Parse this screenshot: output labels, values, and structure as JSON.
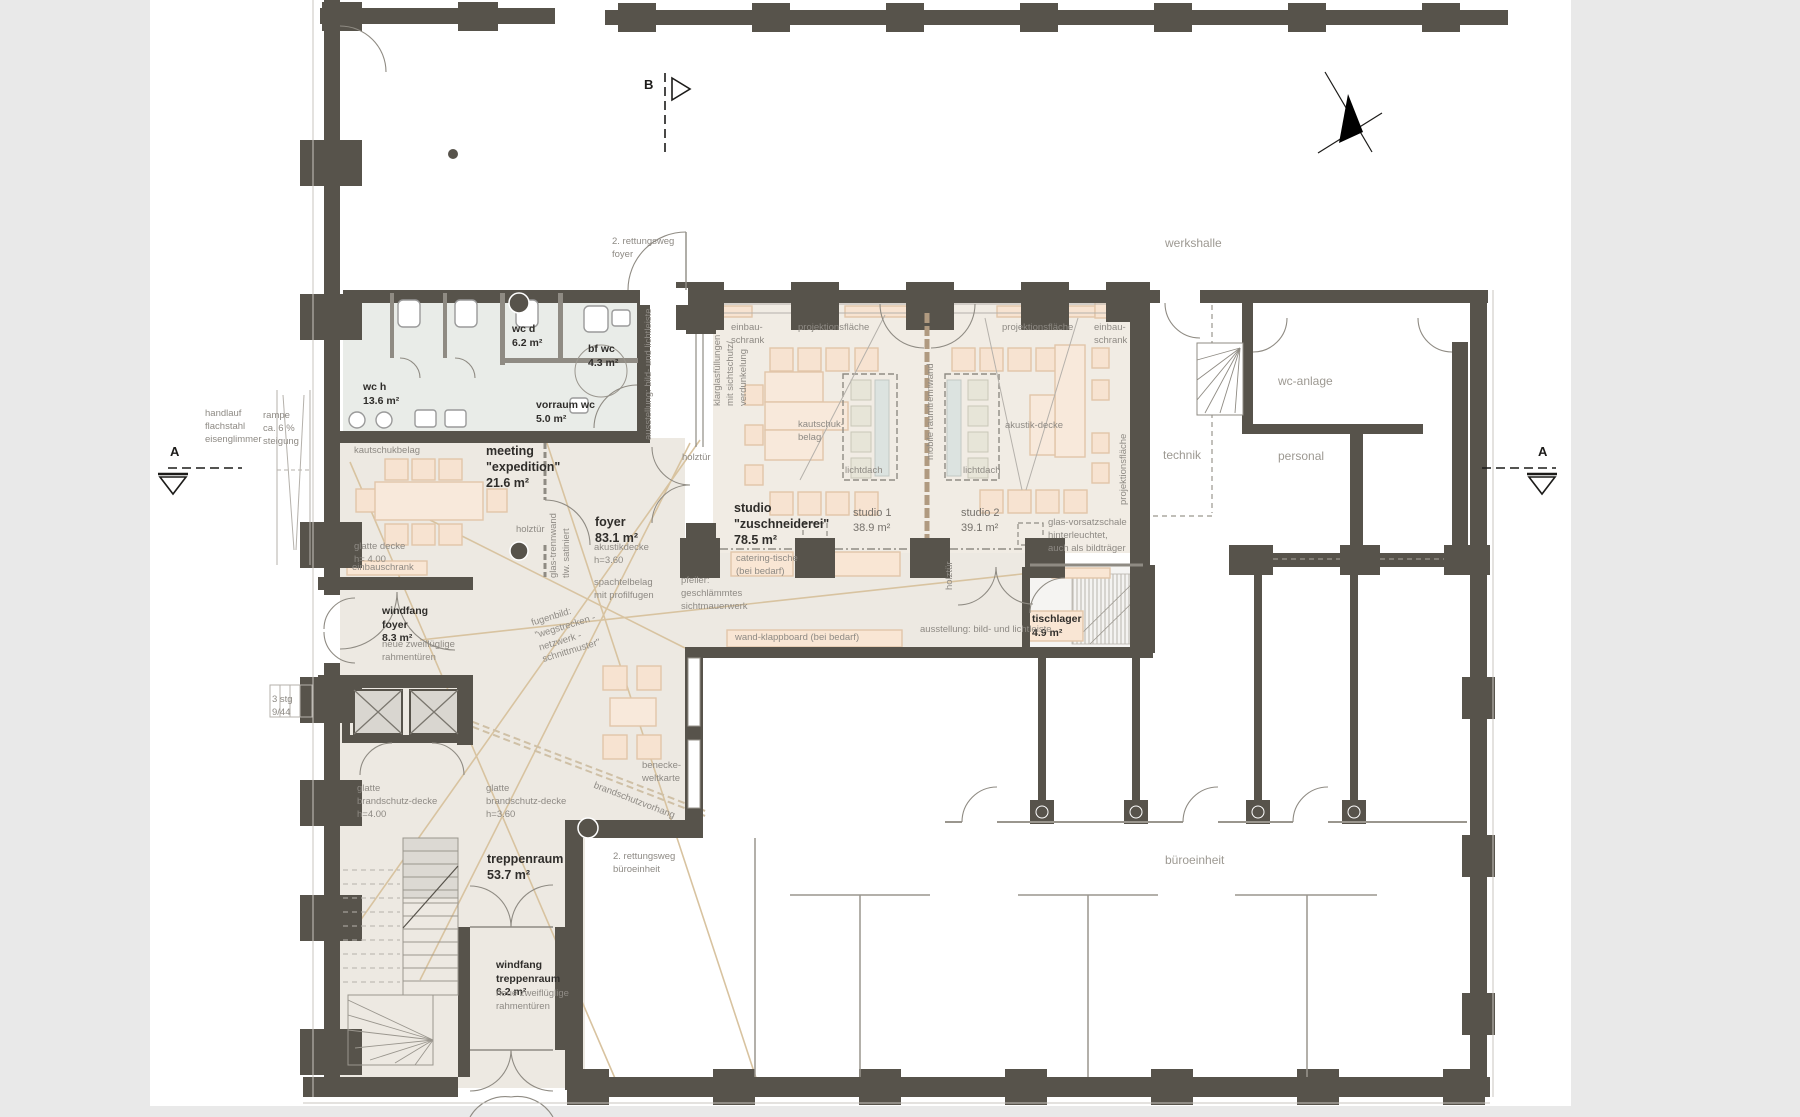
{
  "markers": {
    "a_left": "A",
    "a_right": "A",
    "b_top": "B"
  },
  "context": {
    "werkshalle": "werkshalle",
    "bueroeinheit": "büroeinheit",
    "technik": "technik",
    "wc_anlage": "wc-anlage",
    "personal": "personal"
  },
  "rooms": {
    "wc_h": "wc h\n13.6 m²",
    "wc_d": "wc d\n6.2 m²",
    "bf_wc": "bf wc\n4.3 m²",
    "vorraum_wc": "vorraum wc\n5.0 m²",
    "meeting": "meeting\n\"expedition\"\n21.6 m²",
    "foyer": "foyer\n83.1 m²",
    "studio_zuschneiderei": "studio\n\"zuschneiderei\"\n78.5 m²",
    "studio_1": "studio 1\n38.9 m²",
    "studio_2": "studio 2\n39.1 m²",
    "windfang_foyer": "windfang\nfoyer\n8.3 m²",
    "treppenraum": "treppenraum\n53.7 m²",
    "windfang_treppenraum": "windfang\ntreppenraum\n6.2 m²",
    "tischlager": "tischlager\n4.9 m²"
  },
  "annotations": {
    "handlauf": "handlauf\nflachstahl\neisenglimmer",
    "rampe": "rampe\nca. 6 %\nsteigung",
    "rettungsweg_foyer": "2. rettungsweg\nfoyer",
    "rettungsweg_buero": "2. rettungsweg\nbüroeinheit",
    "kautschukbelag_meeting": "kautschukbelag",
    "glatte_decke_meeting": "glatte decke\nh= 4.00",
    "einbauschrank_meeting": "einbauschrank",
    "glas_trennwand": "glas-trennwand\ntlw. satiniert",
    "holztuer_meeting": "holztür",
    "holztuer_foyer": "holztür",
    "holztuer_studio2": "holztür",
    "ausstellung_vertikal": "ausstellung: bild- und lichtleiste",
    "ausstellung_horizontal": "ausstellung: bild- und lichtleiste",
    "einbau_schrank_1": "einbau-\nschrank",
    "einbau_schrank_2": "einbau-\nschrank",
    "projektionsflaeche_1": "projektionsfläche",
    "projektionsflaeche_2": "projektionsfläche",
    "projektionsflaeche_v": "projektionsfläche",
    "klarglas": "klarglasfüllungen\nmit sichtschutz/\nverdunkelung",
    "kautschuk_belag_studio": "kautschuk-\nbelag",
    "lichtdach_1": "lichtdach",
    "lichtdach_2": "lichtdach",
    "akustik_decke": "akustik-decke",
    "mobile_raumtrennwand": "mobile raumtrennwand",
    "glas_vorsatzschale": "glas-vorsatzschale\nhinterleuchtet,\nauch als bildträger",
    "catering_tische": "catering-tische\n(bei bedarf)",
    "wand_klappboard": "wand-klappboard (bei bedarf)",
    "pfeiler": "pfeiler:\ngeschlämmtes\nsichtmauerwerk",
    "akustikdecke_foyer": "akustikdecke\nh=3.60",
    "spachtelbelag": "spachtelbelag\nmit profilfugen",
    "fugenbild": "fugenbild:\n\"wegstrecken -\nnetzwerk -\nschnittmuster\"",
    "benecke": "benecke-\nweltkarte",
    "brandschutzvorhang": "brandschutzvorhang",
    "rahmentueren_1": "neue zweiflüglige\nrahmentüren",
    "rahmentueren_2": "neue zweiflüglige\nrahmentüren",
    "brandschutz_decke_400": "glatte\nbrandschutz-decke\nh=4.00",
    "brandschutz_decke_360": "glatte\nbrandschutz-decke\nh=3.60",
    "stg": "3 stg\n9/44"
  },
  "colors": {
    "wall": "#57534b",
    "floor_warm": "#ede9e2",
    "floor_studio": "#f1ece4",
    "floor_wc": "#e9ece8",
    "furniture_fill": "#f7e3d1",
    "furniture_border": "#e2c5a9",
    "fugenbild_line": "#d8c3a0",
    "annotation_text": "#8e8a84",
    "room_text": "#2f2d2a"
  }
}
